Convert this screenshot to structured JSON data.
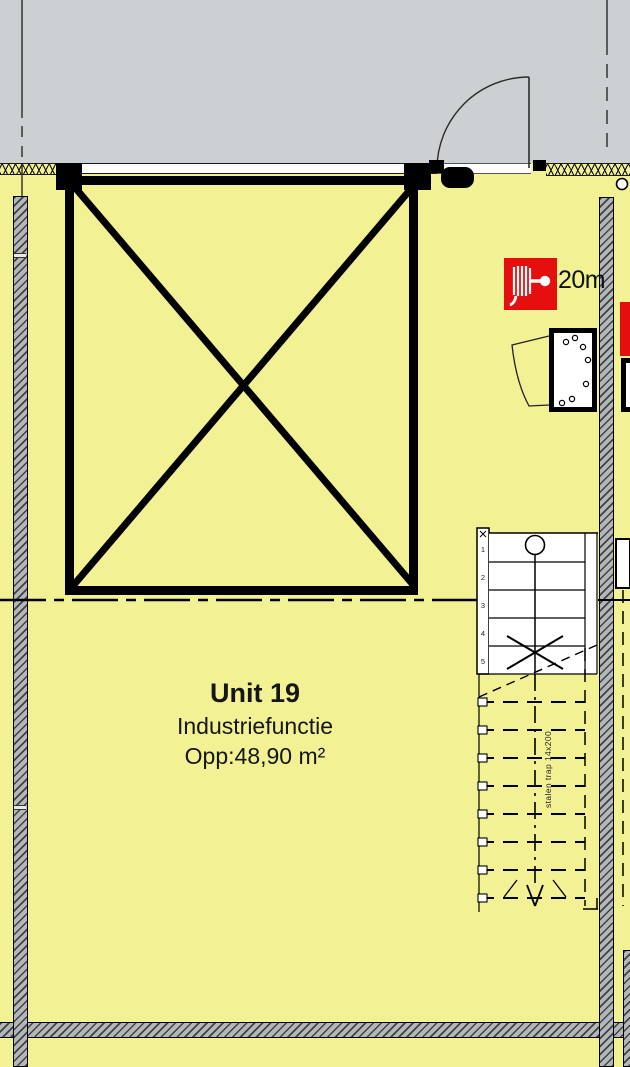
{
  "unit": {
    "name": "Unit 19",
    "function": "Industriefunctie",
    "area": "Opp:48,90 m²"
  },
  "fire_hose": {
    "label": "20m"
  },
  "stair": {
    "annotation": "stalen trap 14x200",
    "tread_numbers": [
      "1",
      "2",
      "3",
      "4",
      "5"
    ]
  },
  "colors": {
    "floor": "#f2f193",
    "outside": "#cdd0d3",
    "wall_fill": "#b3b7ba",
    "red": "#e60f0f"
  }
}
